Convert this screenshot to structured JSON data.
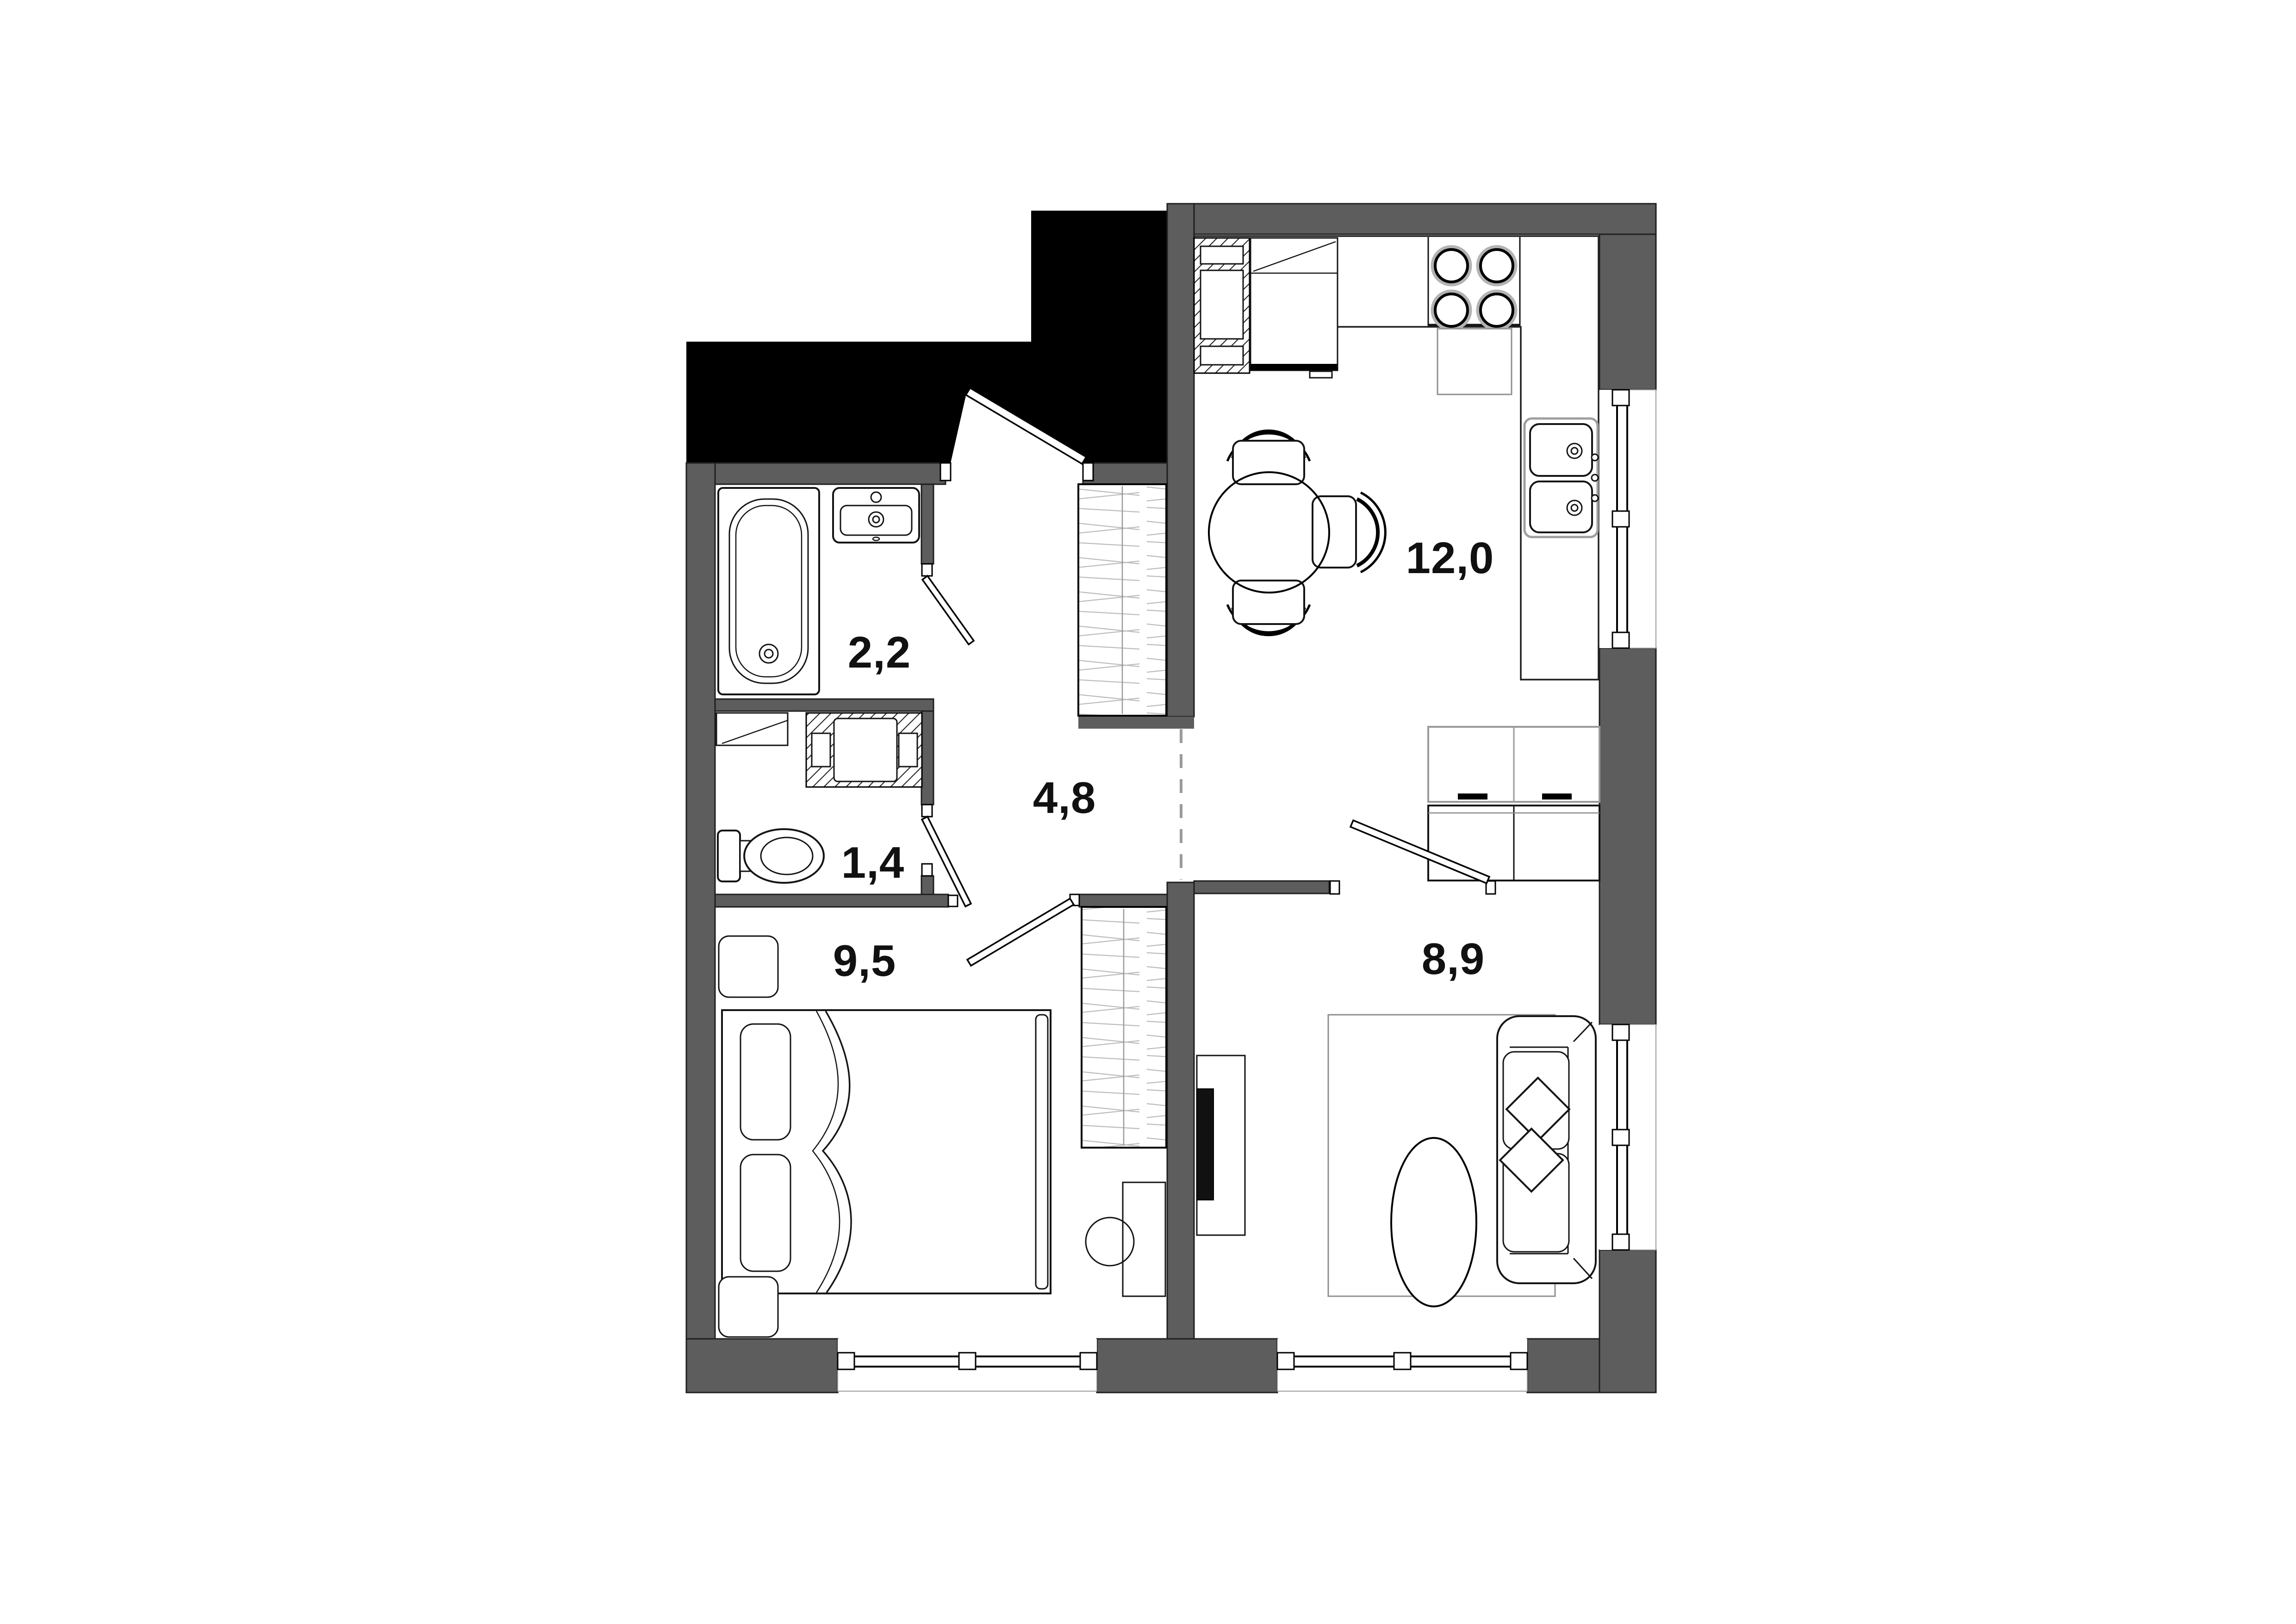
{
  "plan": {
    "title": "apartment-floor-plan",
    "rooms": [
      {
        "id": "bathroom",
        "area_label": "2,2",
        "area_m2": 2.2,
        "features": [
          "bathtub",
          "sink",
          "door"
        ]
      },
      {
        "id": "toilet",
        "area_label": "1,4",
        "area_m2": 1.4,
        "features": [
          "toilet",
          "washing-machine",
          "door"
        ]
      },
      {
        "id": "hallway",
        "area_label": "4,8",
        "area_m2": 4.8,
        "features": [
          "wardrobe",
          "entrance-door"
        ]
      },
      {
        "id": "bedroom",
        "area_label": "9,5",
        "area_m2": 9.5,
        "features": [
          "double-bed",
          "nightstands",
          "wardrobe",
          "desk",
          "stool",
          "window"
        ]
      },
      {
        "id": "kitchen",
        "area_label": "12,0",
        "area_m2": 12.0,
        "features": [
          "fridge",
          "oven",
          "stove-4-burners",
          "double-sink",
          "dining-table",
          "chairs",
          "cabinets",
          "window"
        ]
      },
      {
        "id": "living-room",
        "area_label": "8,9",
        "area_m2": 8.9,
        "features": [
          "sofa",
          "pillows",
          "rug",
          "coffee-table",
          "tv-stand",
          "windows"
        ]
      }
    ],
    "colors": {
      "background": "#ffffff",
      "wall": "#5d5d5d",
      "stair_void": "#000000",
      "hatch_light": "#bcbcbc",
      "label_text": "#111111"
    }
  }
}
